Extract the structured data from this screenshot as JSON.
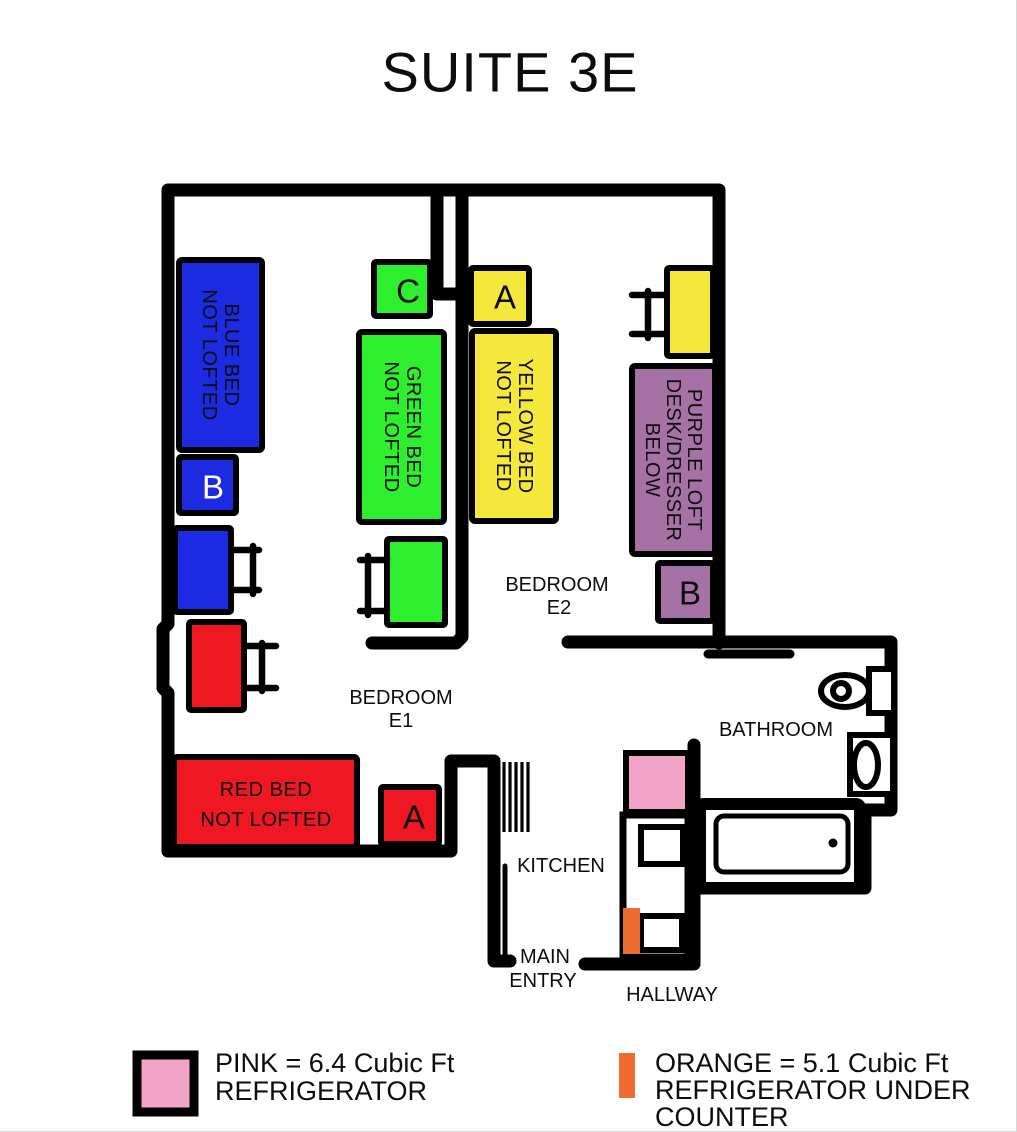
{
  "title": "SUITE 3E",
  "colors": {
    "blue": "#1c2be1",
    "green": "#2eef2e",
    "yellow": "#f6e83b",
    "purple": "#a672a6",
    "red": "#ef1822",
    "pink": "#f2a3c8",
    "orange": "#ee6c30",
    "wall": "#000000"
  },
  "rooms": {
    "bedroom_e1": {
      "line1": "BEDROOM",
      "line2": "E1"
    },
    "bedroom_e2": {
      "line1": "BEDROOM",
      "line2": "E2"
    },
    "bathroom": {
      "label": "BATHROOM"
    },
    "kitchen": {
      "label": "KITCHEN"
    },
    "main_entry": {
      "line1": "MAIN",
      "line2": "ENTRY"
    },
    "hallway": {
      "label": "HALLWAY"
    }
  },
  "furniture": {
    "blue_bed": {
      "lines": [
        "BLUE BED",
        "NOT LOFTED"
      ]
    },
    "blue_closet": {
      "letter": "B"
    },
    "green_closet": {
      "letter": "C"
    },
    "green_bed": {
      "lines": [
        "GREEN BED",
        "NOT LOFTED"
      ]
    },
    "yellow_closet": {
      "letter": "A"
    },
    "yellow_bed": {
      "lines": [
        "YELLOW BED",
        "NOT LOFTED"
      ]
    },
    "red_bed": {
      "lines": [
        "RED BED",
        "NOT LOFTED"
      ]
    },
    "red_closet": {
      "letter": "A"
    },
    "purple_loft": {
      "lines": [
        "PURPLE LOFT",
        "DESK/DRESSER",
        "BELOW"
      ]
    },
    "purple_closet": {
      "letter": "B"
    }
  },
  "legend": {
    "pink": {
      "lines": [
        "PINK = 6.4 Cubic Ft",
        "REFRIGERATOR"
      ]
    },
    "orange": {
      "lines": [
        "ORANGE = 5.1 Cubic Ft",
        "REFRIGERATOR UNDER",
        "COUNTER"
      ]
    }
  }
}
